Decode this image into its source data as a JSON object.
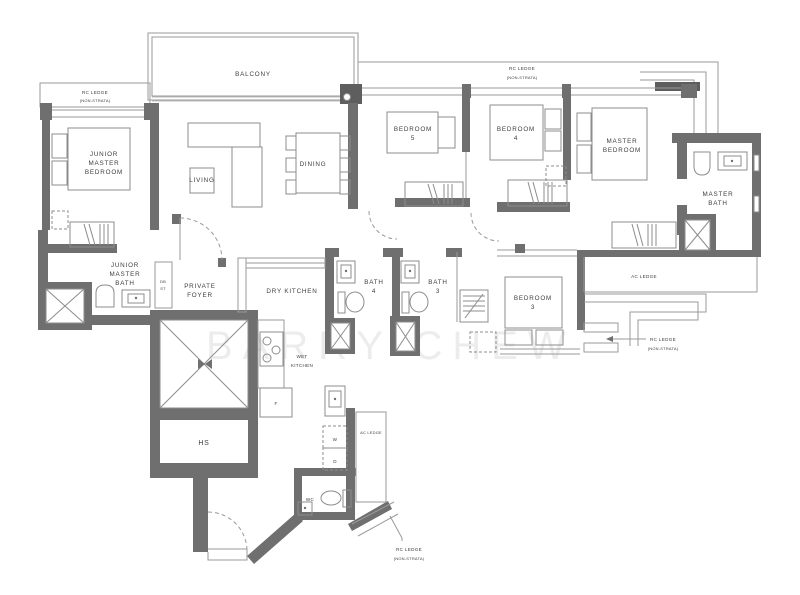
{
  "floorplan": {
    "watermark": "BARRY CHEW",
    "labels": {
      "balcony": "BALCONY",
      "rc_ledge": "RC LEDGE",
      "non_strata": "(NON-STRATA)",
      "ac_ledge": "AC LEDGE",
      "junior_master_bedroom": [
        "JUNIOR",
        "MASTER",
        "BEDROOM"
      ],
      "living": "LIVING",
      "dining": "DINING",
      "bedroom": "BEDROOM",
      "bedroom5_no": "5",
      "bedroom4_no": "4",
      "bedroom3_no": "3",
      "master_bedroom": [
        "MASTER",
        "BEDROOM"
      ],
      "master_bath": [
        "MASTER",
        "BATH"
      ],
      "junior_master_bath": [
        "JUNIOR",
        "MASTER",
        "BATH"
      ],
      "private_foyer": [
        "PRIVATE",
        "FOYER"
      ],
      "dry_kitchen": "DRY KITCHEN",
      "wet_kitchen": [
        "WET",
        "KITCHEN"
      ],
      "bath": "BATH",
      "bath4_no": "4",
      "bath3_no": "3",
      "db": "DB",
      "st": "ST",
      "hs": "HS",
      "fridge": "F",
      "washer": "W",
      "dryer": "D",
      "wc": "WC"
    }
  }
}
